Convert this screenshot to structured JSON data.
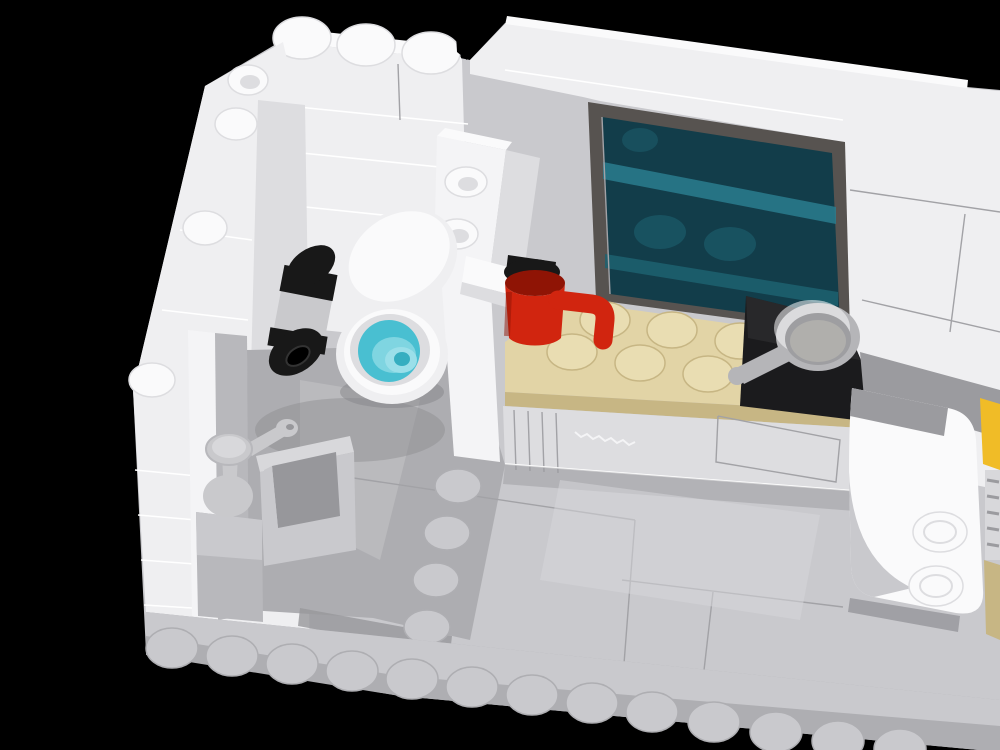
{
  "meta": {
    "kind": "3d-render",
    "description": "LEGO brick room interior viewed from above-front: bathroom (left) with toilet, toilet-paper roll and sink; kitchen (right) with tan studded counter, red tap-mug, black stove tile, gray frying pan and a dark teal display window; white walls, light gray studded base plates, black background"
  },
  "colors": {
    "bg": "#000000",
    "white_top": "#fafafb",
    "white_wall": "#efeff1",
    "white_wall_shade": "#dddde0",
    "white_panel": "#f4f4f6",
    "gray_plate": "#c9c9cd",
    "gray_plate_dark": "#aeaeb2",
    "gray_mid": "#b8b8bc",
    "gray_floor": "#adadb1",
    "gray_deep": "#97979b",
    "gray_band": "#9b9b9f",
    "gray_shadow": "#86868a",
    "seam": "#ffffff",
    "seam_dark": "#a2a2a6",
    "frame": "#575350",
    "glass": "#123d4a",
    "glass_band": "#2a7d8e",
    "glass_hint": "#1d6170",
    "tan_top": "#e2d4a6",
    "tan_side": "#c7b684",
    "tan_stud": "#e9ddb2",
    "red_body": "#d1250f",
    "red_dark": "#8f1405",
    "black_tile": "#1b1b1d",
    "black_cap": "#181818",
    "pan_body": "#b5b5b8",
    "pan_inner": "#9e9ea1",
    "pan_floor": "#b0afac",
    "metal_light": "#c9c9cc",
    "water": "#49bfd1",
    "water_light": "#7fd5e1",
    "drain": "#9adfe9",
    "drain_hole": "#35aec0",
    "yellow_accent": "#f0bc27",
    "dash_gray": "#d8d8db"
  },
  "objects": [
    {
      "id": "left-wall",
      "label": "white brick wall, left, studded top edge",
      "color": "white_wall"
    },
    {
      "id": "back-wall",
      "label": "white brick wall, bathroom back, 3 studs on top",
      "color": "white_wall"
    },
    {
      "id": "right-wall",
      "label": "white brick wall, kitchen back/right",
      "color": "white_wall"
    },
    {
      "id": "display-window",
      "label": "dark-framed cabinet window, transparent teal glass, shelves behind",
      "colors": [
        "frame",
        "glass",
        "glass_band"
      ]
    },
    {
      "id": "divider-pillar",
      "label": "white pillar with two hollow studs facing viewer",
      "color": "white_panel"
    },
    {
      "id": "kitchen-counter",
      "label": "tan studded countertop",
      "colors": [
        "tan_top",
        "tan_stud"
      ]
    },
    {
      "id": "red-tap-mug",
      "label": "red mug/tap with curved spout on counter left",
      "color": "red_body"
    },
    {
      "id": "stove-tile",
      "label": "black smooth stove tile",
      "color": "black_tile"
    },
    {
      "id": "frying-pan",
      "label": "gray frying pan with handle toward lower-left",
      "color": "pan_body"
    },
    {
      "id": "toilet",
      "label": "white toilet, lid raised, azure water and drain inside",
      "colors": [
        "white_top",
        "water",
        "drain"
      ]
    },
    {
      "id": "toilet-paper-roll",
      "label": "gray paper roll with black end caps on wall",
      "colors": [
        "metal_light",
        "black_cap"
      ]
    },
    {
      "id": "sink",
      "label": "gray sink basin, pedestal and lever faucet, bottom-left",
      "colors": [
        "gray_mid",
        "metal_light"
      ]
    },
    {
      "id": "arch-bracket",
      "label": "white curved bracket with two side studs, right",
      "color": "white_top"
    },
    {
      "id": "yellow-ladder",
      "label": "yellow element with white rungs at right edge",
      "color": "yellow_accent"
    },
    {
      "id": "base-plates",
      "label": "light gray base plates, stud row along front edge",
      "color": "gray_plate"
    }
  ]
}
